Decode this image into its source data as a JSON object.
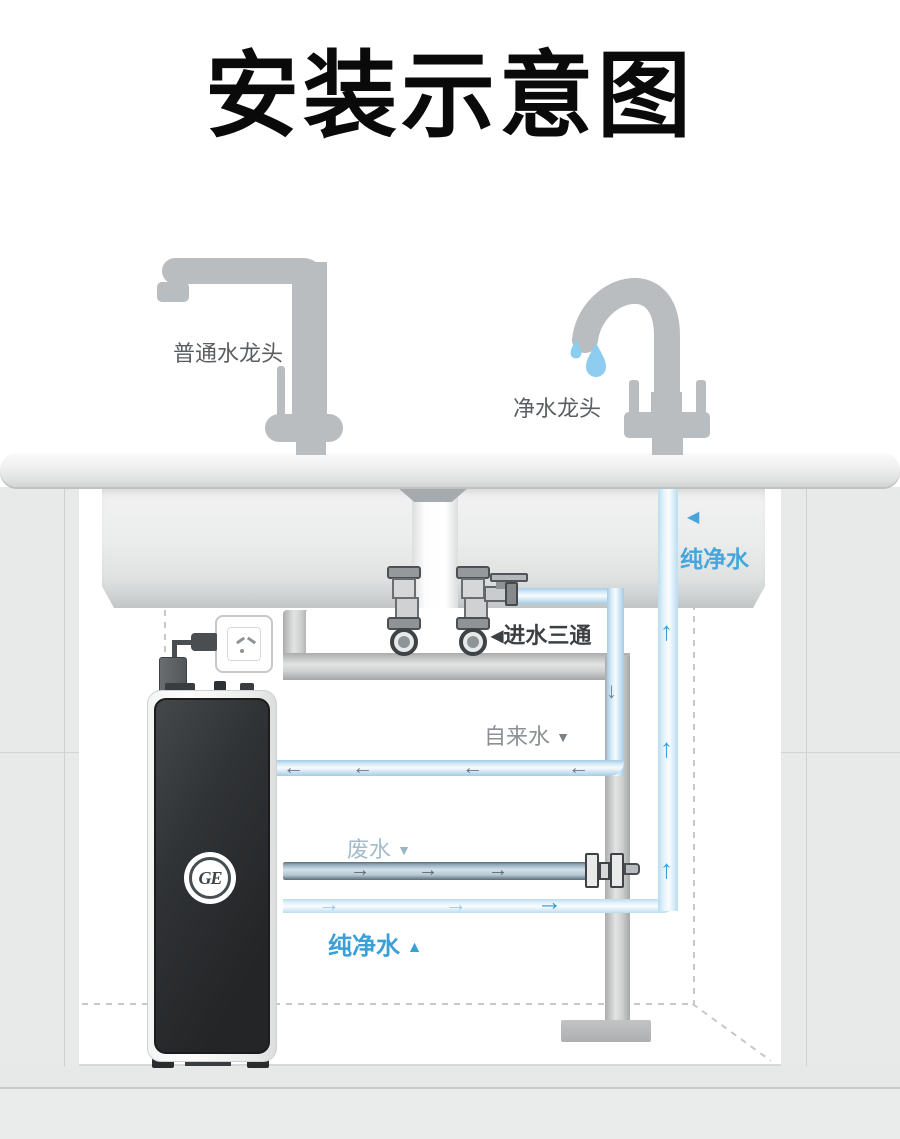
{
  "title": "安装示意图",
  "faucets": {
    "ordinary_label": "普通水龙头",
    "pure_label": "净水龙头"
  },
  "pipes": {
    "pure_water_top_label": "纯净水",
    "inlet_tee_label": "进水三通",
    "tap_water_label": "自来水",
    "waste_water_label": "废水",
    "pure_water_bottom_label": "纯净水"
  },
  "device": {
    "brand": "GE"
  },
  "glyphs": {
    "left_tri": "◀",
    "down_tri": "▼",
    "up_tri": "▲",
    "arrow_left": "←",
    "arrow_right": "→",
    "arrow_up": "↑",
    "arrow_down": "↓"
  },
  "colors": {
    "accent_blue": "#3b9fd8",
    "pipe_blue": "#bcd9ec",
    "waste_blue": "#b9cdd9",
    "faucet_gray": "#b9bdbf",
    "title_black": "#0a0a0a"
  }
}
